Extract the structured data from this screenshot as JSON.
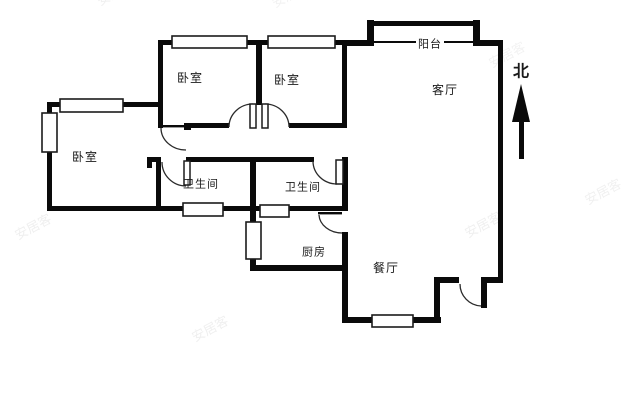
{
  "canvas": {
    "width": 640,
    "height": 400,
    "background": "#ffffff"
  },
  "colors": {
    "wall": "#0a0a0a",
    "window_fill": "#ffffff",
    "window_stroke": "#1c1c1c",
    "arc_stroke": "#2b2b2b",
    "label_text": "#1a1a1a",
    "watermark": "#8a8a8a"
  },
  "plan": {
    "walls": [
      [
        158,
        40,
        189,
        5
      ],
      [
        342,
        40,
        32,
        6
      ],
      [
        474,
        40,
        29,
        6
      ],
      [
        158,
        40,
        5,
        88
      ],
      [
        256,
        43,
        6,
        62
      ],
      [
        342,
        40,
        5,
        87
      ],
      [
        289,
        123,
        58,
        5
      ],
      [
        186,
        123,
        43,
        5
      ],
      [
        184,
        123,
        7,
        7
      ],
      [
        47,
        102,
        113,
        5
      ],
      [
        47,
        102,
        5,
        109
      ],
      [
        47,
        206,
        299,
        5
      ],
      [
        147,
        157,
        14,
        5
      ],
      [
        147,
        157,
        5,
        11
      ],
      [
        156,
        157,
        5,
        54
      ],
      [
        186,
        157,
        128,
        5
      ],
      [
        250,
        158,
        6,
        52
      ],
      [
        342,
        157,
        6,
        54
      ],
      [
        250,
        206,
        6,
        65
      ],
      [
        250,
        265,
        98,
        6
      ],
      [
        342,
        232,
        6,
        90
      ],
      [
        342,
        317,
        99,
        6
      ],
      [
        434,
        277,
        6,
        46
      ],
      [
        434,
        277,
        25,
        6
      ],
      [
        481,
        277,
        22,
        6
      ],
      [
        498,
        40,
        5,
        243
      ],
      [
        367,
        20,
        7,
        26
      ],
      [
        473,
        20,
        7,
        26
      ],
      [
        370,
        21,
        108,
        5
      ]
    ],
    "windows": [
      [
        172,
        36,
        75,
        12
      ],
      [
        268,
        36,
        67,
        12
      ],
      [
        60,
        99,
        63,
        13
      ],
      [
        42,
        113,
        15,
        39
      ],
      [
        183,
        203,
        40,
        13
      ],
      [
        260,
        205,
        29,
        12
      ],
      [
        246,
        222,
        15,
        37
      ],
      [
        372,
        315,
        41,
        12
      ]
    ],
    "thin_lines": [
      [
        374,
        41,
        100,
        2
      ],
      [
        161,
        125,
        24,
        2.4
      ],
      [
        318,
        212,
        24,
        2.4
      ]
    ],
    "door_leaves_outlined": [
      [
        250,
        104,
        6,
        24
      ],
      [
        262,
        104,
        6,
        24
      ],
      [
        184,
        161,
        6,
        24
      ],
      [
        336,
        160,
        7,
        24
      ]
    ],
    "door_leaves_solid": [
      [
        481,
        283,
        6,
        25
      ]
    ],
    "door_arcs": [
      "M161,128 A25,22 0 0 0 186,150",
      "M162,162 A24,24 0 0 0 186,186",
      "M313,161 A24,23 0 0 0 337,184",
      "M229,127 A24,23 0 0 1 253,104",
      "M265,104 A24,23 0 0 1 289,127",
      "M319,215 A23,19 0 0 0 342,233",
      "M460,284 A22,22 0 0 0 481,306"
    ],
    "rooms": [
      {
        "id": "bedroom-1",
        "label": "卧室",
        "x": 190,
        "y": 78,
        "size": 12,
        "bold": false,
        "bg": false
      },
      {
        "id": "bedroom-2",
        "label": "卧室",
        "x": 287,
        "y": 80,
        "size": 12,
        "bold": false,
        "bg": false
      },
      {
        "id": "bedroom-3",
        "label": "卧室",
        "x": 85,
        "y": 157,
        "size": 12,
        "bold": false,
        "bg": false
      },
      {
        "id": "bathroom-1",
        "label": "卫生间",
        "x": 201,
        "y": 184,
        "size": 11,
        "bold": false,
        "bg": false
      },
      {
        "id": "bathroom-2",
        "label": "卫生间",
        "x": 303,
        "y": 187,
        "size": 11,
        "bold": false,
        "bg": false
      },
      {
        "id": "kitchen",
        "label": "厨房",
        "x": 314,
        "y": 252,
        "size": 11,
        "bold": false,
        "bg": false
      },
      {
        "id": "dining-room",
        "label": "餐厅",
        "x": 386,
        "y": 268,
        "size": 12,
        "bold": false,
        "bg": false
      },
      {
        "id": "living-room",
        "label": "客厅",
        "x": 445,
        "y": 90,
        "size": 12,
        "bold": false,
        "bg": false
      },
      {
        "id": "balcony",
        "label": "阳台",
        "x": 430,
        "y": 44,
        "size": 11,
        "bold": false,
        "bg": true
      }
    ],
    "compass": {
      "label": "北",
      "label_x": 521,
      "label_y": 71,
      "label_size": 16,
      "triangle_points": "521,84 512,122 530,122",
      "stem": [
        519,
        122,
        5,
        37
      ]
    },
    "watermarks": [
      {
        "text": "安居客",
        "x": 100,
        "y": 6,
        "rot": -28,
        "size": 13,
        "opacity": 0.12
      },
      {
        "text": "安居客",
        "x": 275,
        "y": 8,
        "rot": -28,
        "size": 13,
        "opacity": 0.1
      },
      {
        "text": "安居客",
        "x": 18,
        "y": 240,
        "rot": -28,
        "size": 13,
        "opacity": 0.13
      },
      {
        "text": "安居客",
        "x": 195,
        "y": 342,
        "rot": -28,
        "size": 13,
        "opacity": 0.13
      },
      {
        "text": "安居客",
        "x": 468,
        "y": 238,
        "rot": -28,
        "size": 13,
        "opacity": 0.13
      },
      {
        "text": "安居客",
        "x": 588,
        "y": 205,
        "rot": -28,
        "size": 13,
        "opacity": 0.12
      },
      {
        "text": "安居客",
        "x": 492,
        "y": 68,
        "rot": -28,
        "size": 13,
        "opacity": 0.1
      }
    ]
  }
}
